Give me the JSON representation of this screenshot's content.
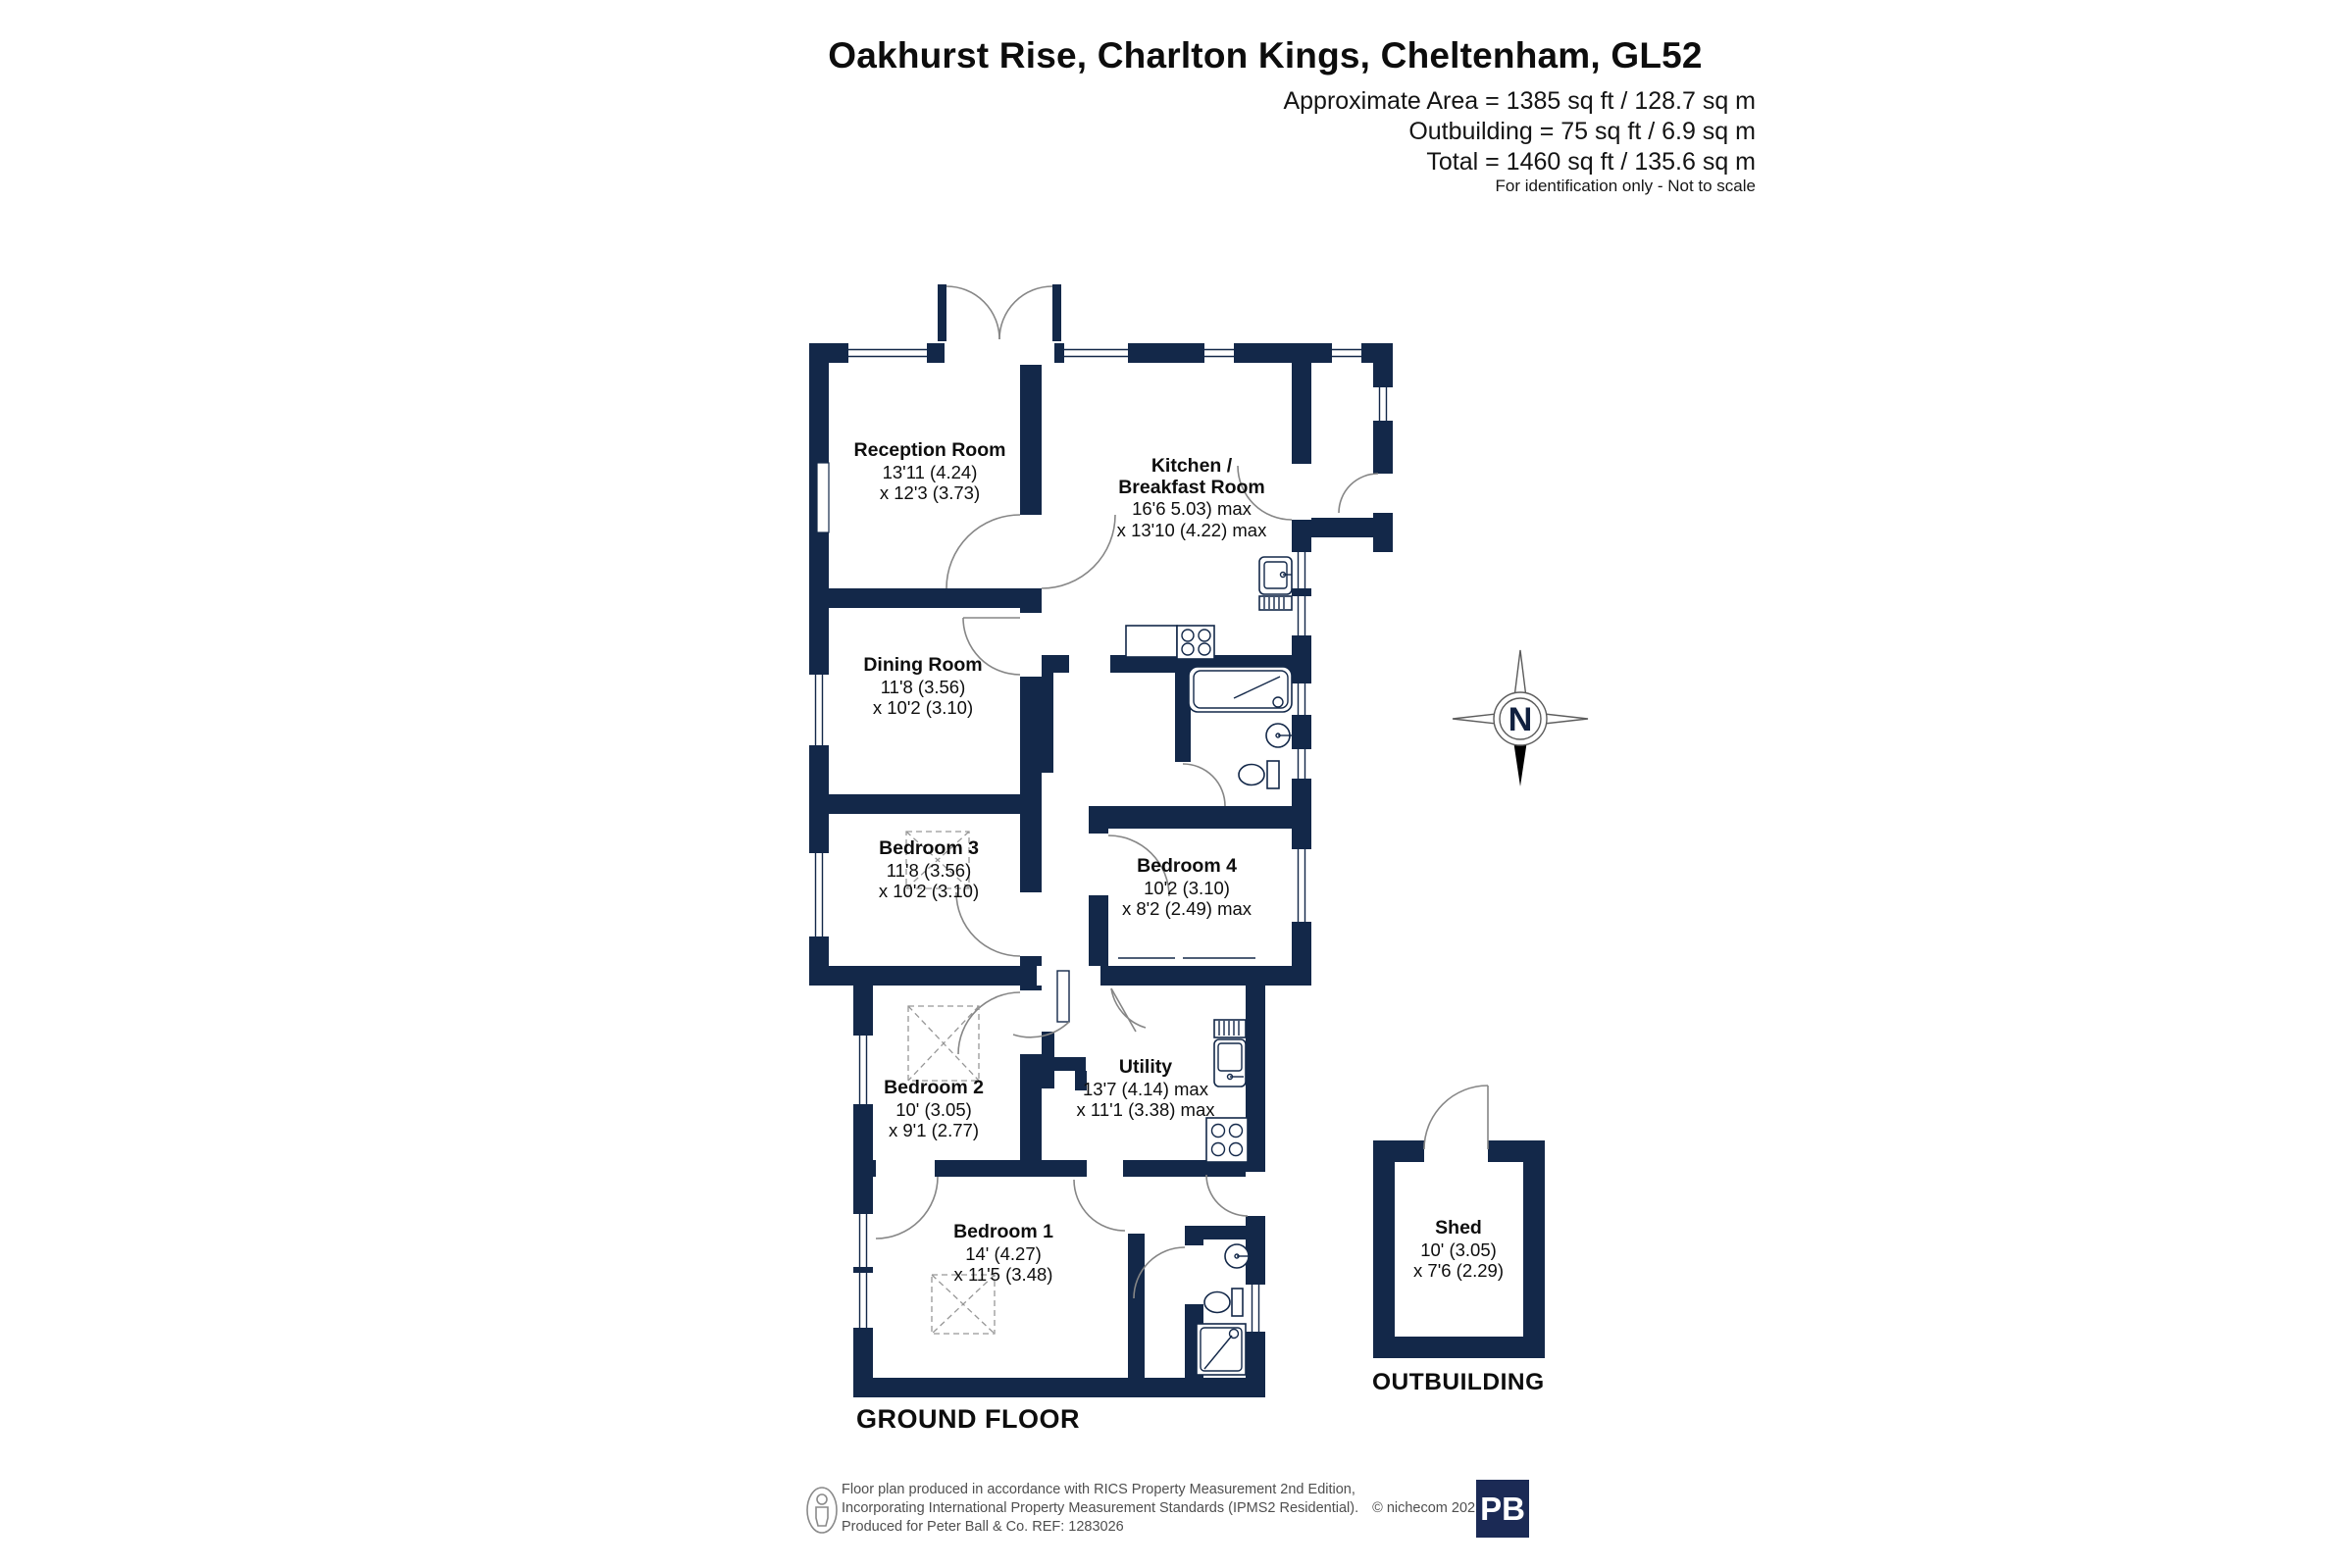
{
  "header": {
    "title": "Oakhurst Rise, Charlton Kings, Cheltenham, GL52",
    "area_lines": [
      "Approximate Area = 1385 sq ft / 128.7 sq m",
      "Outbuilding = 75 sq ft / 6.9 sq m",
      "Total = 1460 sq ft / 135.6 sq m"
    ],
    "disclaimer": "For identification only - Not to scale"
  },
  "plan": {
    "floor_label": "GROUND FLOOR",
    "outbuilding_label": "OUTBUILDING",
    "compass_label": "N",
    "rooms": [
      {
        "id": "reception-room",
        "lines": [
          "Reception Room",
          "13'11 (4.24)",
          "x 12'3 (3.73)"
        ]
      },
      {
        "id": "kitchen-breakfast-room",
        "lines": [
          "Kitchen /",
          "Breakfast Room",
          "16'6 5.03) max",
          "x 13'10 (4.22) max"
        ]
      },
      {
        "id": "dining-room",
        "lines": [
          "Dining Room",
          "11'8 (3.56)",
          "x 10'2 (3.10)"
        ]
      },
      {
        "id": "bedroom-3",
        "lines": [
          "Bedroom 3",
          "11'8 (3.56)",
          "x 10'2 (3.10)"
        ]
      },
      {
        "id": "bedroom-4",
        "lines": [
          "Bedroom 4",
          "10'2 (3.10)",
          "x 8'2 (2.49) max"
        ]
      },
      {
        "id": "bedroom-2",
        "lines": [
          "Bedroom 2",
          "10' (3.05)",
          "x 9'1 (2.77)"
        ]
      },
      {
        "id": "utility",
        "lines": [
          "Utility",
          "13'7 (4.14) max",
          "x 11'1 (3.38) max"
        ]
      },
      {
        "id": "bedroom-1",
        "lines": [
          "Bedroom 1",
          "14' (4.27)",
          "x 11'5 (3.48)"
        ]
      },
      {
        "id": "shed",
        "lines": [
          "Shed",
          "10' (3.05)",
          "x 7'6 (2.29)"
        ]
      }
    ],
    "icons": [
      "compass-rose-icon",
      "bath-icon",
      "sink-icon",
      "hob-icon",
      "toilet-icon",
      "basin-icon",
      "shower-icon",
      "wardrobe-outline"
    ]
  },
  "footer": {
    "line1": "Floor plan produced in accordance with RICS Property Measurement 2nd Edition,",
    "line2": "Incorporating International Property Measurement Standards (IPMS2 Residential).",
    "copyright": "© nichecom 2025.",
    "line3": "Produced for Peter Ball & Co.   REF: 1283026",
    "logo_text": "PB"
  },
  "colors": {
    "wall": "#132849",
    "door_arc": "#868686",
    "logo_bg": "#1b2a55",
    "text": "#111111",
    "footer_text": "#4f4f4f"
  }
}
